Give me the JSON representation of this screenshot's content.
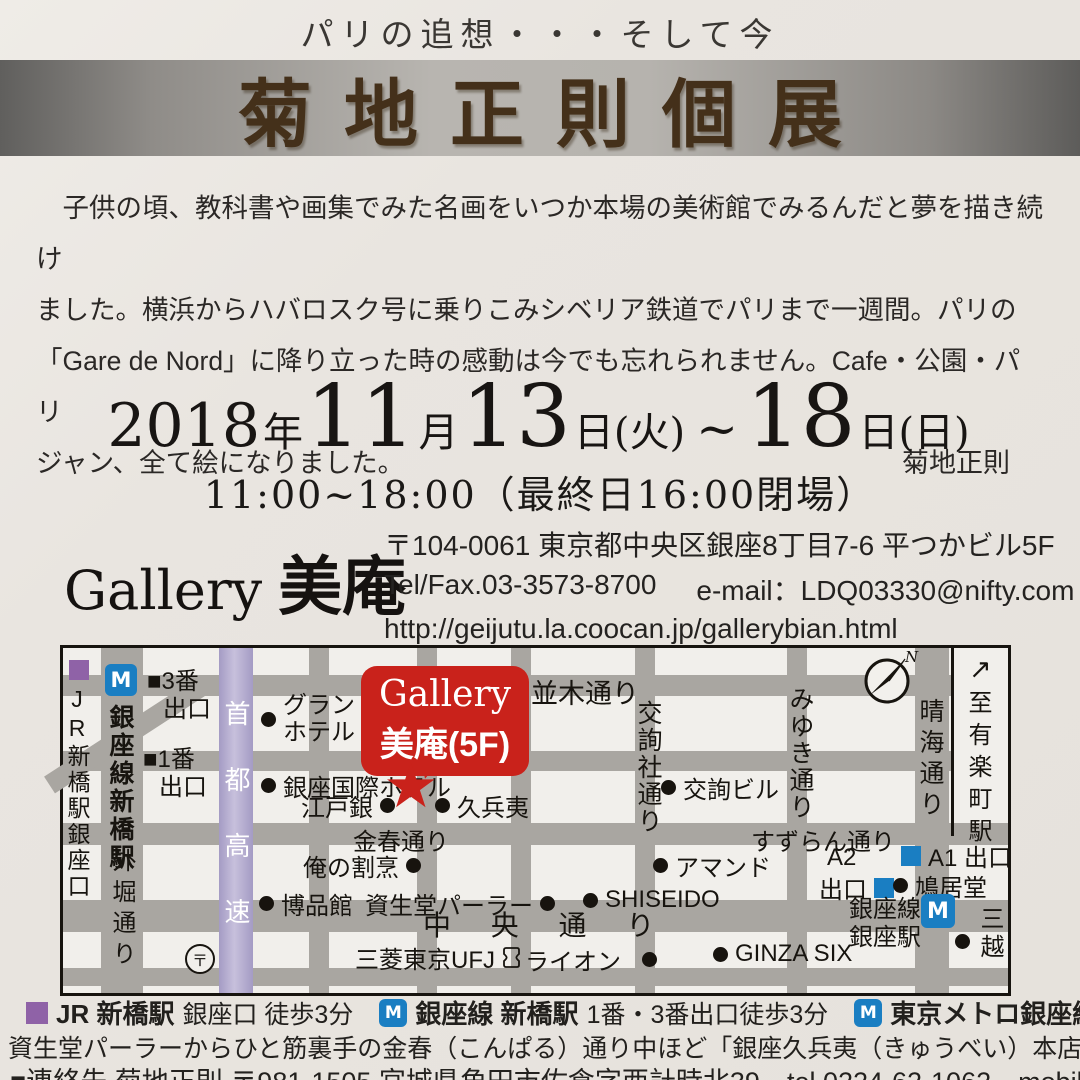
{
  "colors": {
    "accent_red": "#c9221b",
    "metro_blue": "#1a7ec2",
    "jr_purple": "#8f62a7",
    "expressway_purple": "#a49bc4"
  },
  "header": {
    "subtitle": "パリの追想・・・そして今",
    "title": "菊地正則個展"
  },
  "intro": {
    "line1": "　子供の頃、教科書や画集でみた名画をいつか本場の美術館でみるんだと夢を描き続け",
    "line2": "ました。横浜からハバロスク号に乗りこみシベリア鉄道でパリまで一週間。パリの",
    "line3": "「Gare de Nord」に降り立った時の感動は今でも忘れられません。Cafe・公園・パリ",
    "line4": "ジャン、全て絵になりました。",
    "signature": "菊地正則"
  },
  "schedule": {
    "year": "2018",
    "year_unit": "年",
    "month": "11",
    "month_unit": "月",
    "day_start": "13",
    "day_start_unit": "日(火)",
    "tilde": "~",
    "day_end": "18",
    "day_end_unit": "日(日)",
    "hours": "11:00~18:00（最終日16:00閉場）"
  },
  "gallery": {
    "name_en": "Gallery",
    "name_jp": "美庵",
    "postal_address": "〒104-0061 東京都中央区銀座8丁目7-6 平つかビル5F",
    "tel_fax": "Tel/Fax.03-3573-8700",
    "email": "e-mail：LDQ03330@nifty.com",
    "url": "http://geijutu.la.coocan.jp/gallerybian.html"
  },
  "map": {
    "callout": {
      "line1": "Gallery",
      "line2": "美庵(5F)"
    },
    "compass": {
      "n": "N"
    },
    "to_station": {
      "arrow": "↗",
      "label": "至有楽町駅"
    },
    "roads": {
      "namiki": "並木通り",
      "konparu": "金春通り",
      "suzuran": "すずらん通り",
      "chuo": "中 央 通 り",
      "kojunsha": "交詢社通り",
      "miyuki": "みゆき通り",
      "harumi": "晴海通り",
      "sotobori": "外堀通り",
      "shuto": "首都高速"
    },
    "stations": {
      "jr": "JR新橋駅銀座口",
      "ginza_line_shimbashi": "銀座線新橋駅",
      "exit3_line1": "■3番",
      "exit3_line2": "出口",
      "exit1_line1": "■1番",
      "exit1_line2": "出口",
      "metro_m": "M",
      "ginza_sta_line1": "銀座線",
      "ginza_sta_line2": "銀座駅",
      "a1_exit": "A1 出口",
      "a2_line1": "A2",
      "a2_line2": "出口",
      "post_mark": "〒"
    },
    "pois": {
      "grand_hotel_1": "グランド",
      "grand_hotel_2": "ホテル",
      "ginza_intl_hotel": "銀座国際ホテル",
      "edogin": "江戸銀",
      "kyubei": "久兵夷",
      "orenokappo": "俺の割烹",
      "hakuhinkan": "博品館",
      "shiseido_parlor": "資生堂パーラー",
      "shiseido": "SHISEIDO",
      "ufj": "三菱東京UFJ",
      "lion": "ライオン",
      "ginza_six": "GINZA SIX",
      "amand": "アマンド",
      "kojun_bldg": "交詢ビル",
      "hatokyodo": "鳩居堂",
      "mitsukoshi": "三越"
    }
  },
  "legend": {
    "item1_label": "JR 新橋駅",
    "item1_rest": "銀座口 徒歩3分",
    "item2_label": "銀座線 新橋駅",
    "item2_rest": "1番・3番出口徒歩3分",
    "item3_label": "東京メトロ銀座線",
    "item3_rest": "A1・A2出口徒歩5分",
    "note": "資生堂パーラーからひと筋裏手の金春（こんぱる）通り中ほど「銀座久兵夷（きゅうべい）本店」と「江戸銀」の間"
  },
  "contact": {
    "line": "■連絡先 菊地正則 〒981-1505 宮城県角田市佐倉字西計時北39　tel.0224-62-1062　mobile:090-5187-4973"
  }
}
